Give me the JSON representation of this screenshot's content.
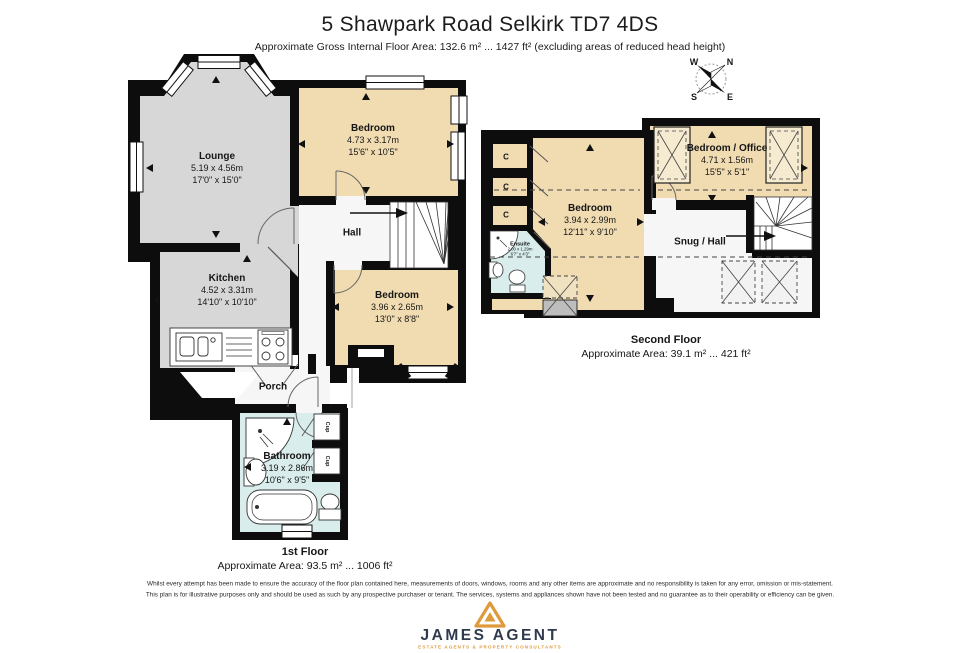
{
  "header": {
    "title": "5 Shawpark Road Selkirk TD7 4DS",
    "subtitle": "Approximate Gross Internal Floor Area: 132.6 m² ... 1427 ft² (excluding areas of reduced head height)"
  },
  "compass": {
    "n": "N",
    "s": "S",
    "e": "E",
    "w": "W"
  },
  "floor1": {
    "name": "1st Floor",
    "area": "Approximate Area: 93.5 m² ... 1006 ft²",
    "rooms": {
      "lounge": {
        "name": "Lounge",
        "metric": "5.19 x 4.56m",
        "imperial": "17'0\" x 15'0\""
      },
      "bedroom1": {
        "name": "Bedroom",
        "metric": "4.73 x 3.17m",
        "imperial": "15'6\" x 10'5\""
      },
      "kitchen": {
        "name": "Kitchen",
        "metric": "4.52 x 3.31m",
        "imperial": "14'10\" x 10'10\""
      },
      "bedroom2": {
        "name": "Bedroom",
        "metric": "3.96 x 2.65m",
        "imperial": "13'0\" x 8'8\""
      },
      "hall": {
        "name": "Hall"
      },
      "porch": {
        "name": "Porch"
      },
      "bathroom": {
        "name": "Bathroom",
        "metric": "3.19 x 2.86m",
        "imperial": "10'6\" x 9'5\""
      },
      "cup1": {
        "name": "Cup"
      },
      "cup2": {
        "name": "Cup"
      }
    }
  },
  "floor2": {
    "name": "Second Floor",
    "area": "Approximate Area: 39.1 m² ... 421 ft²",
    "rooms": {
      "bedroom_office": {
        "name": "Bedroom / Office",
        "metric": "4.71 x 1.56m",
        "imperial": "15'5\" x 5'1\""
      },
      "bedroom": {
        "name": "Bedroom",
        "metric": "3.94 x 2.99m",
        "imperial": "12'11\" x 9'10\""
      },
      "snug": {
        "name": "Snug / Hall"
      },
      "ensuite": {
        "name": "Ensuite",
        "metric": "2.00 x 1.29m",
        "imperial": "6'7\" x 4'3\""
      },
      "closet1": {
        "name": "C"
      },
      "closet2": {
        "name": "C"
      },
      "closet3": {
        "name": "C"
      }
    }
  },
  "disclaimer": {
    "line1": "Whilst every attempt has been made to ensure the accuracy of the floor plan contained here, measurements of doors, windows, rooms and any other items are approximate and no responsibility is taken for any error, omission or mis-statement.",
    "line2": "This plan is for illustrative purposes only and should be used as such by any prospective purchaser or tenant. The services, systems and appliances shown have not been tested and no guarantee as to their operability or efficiency can be given."
  },
  "logo": {
    "name": "JAMES AGENT",
    "tagline": "ESTATE AGENTS & PROPERTY CONSULTANTS"
  },
  "colors": {
    "wall": "#0d0d0d",
    "room_gray": "#d7d7d7",
    "room_tan": "#f1dcb2",
    "room_blue": "#d9edec",
    "room_white": "#f6f6f6",
    "logo_orange": "#df9a3c",
    "logo_navy": "#2f3b4d"
  }
}
